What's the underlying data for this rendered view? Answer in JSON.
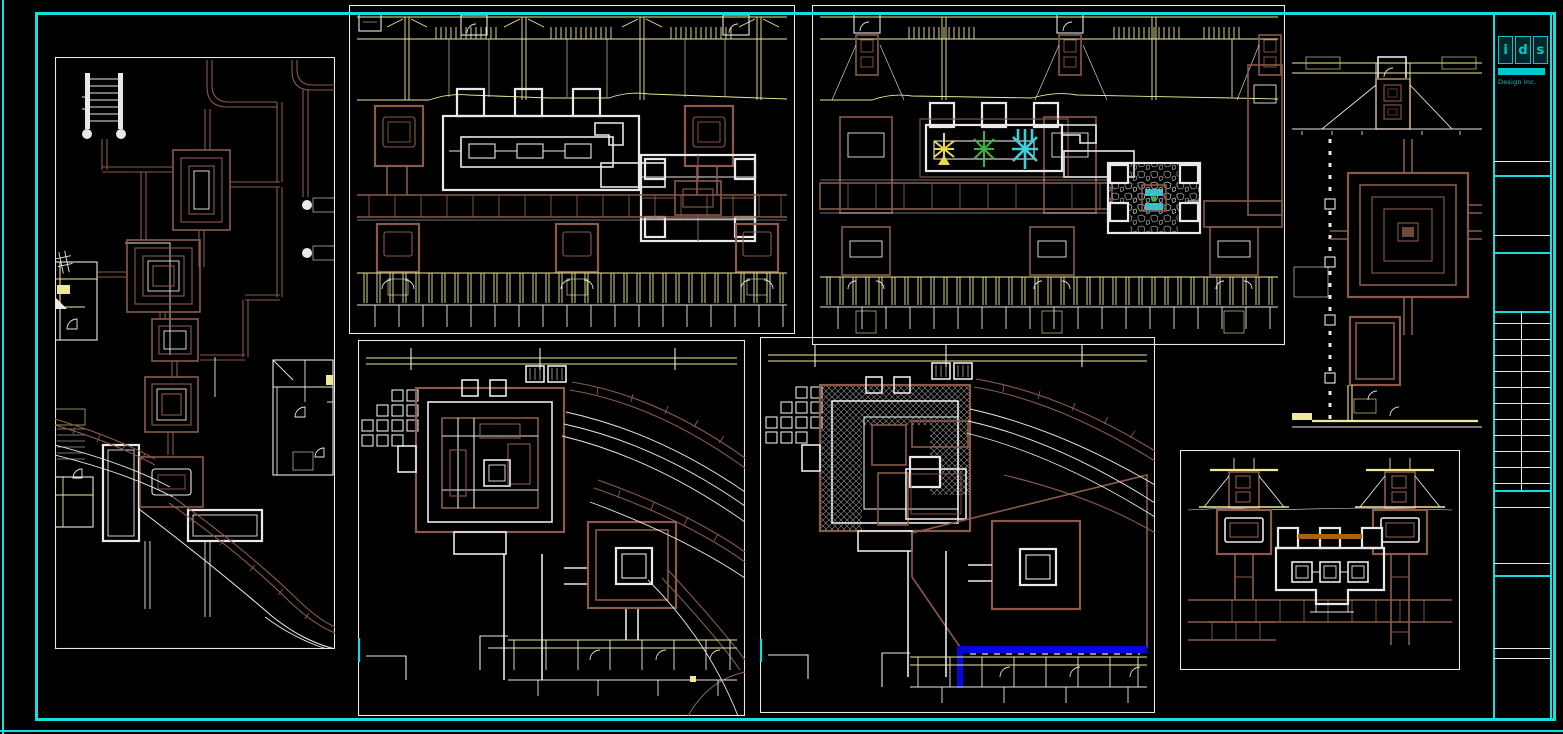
{
  "titleblock": {
    "letters": [
      "i",
      "d",
      "s"
    ],
    "subtitle": "Design Inc."
  },
  "colors": {
    "background": "#000000",
    "frame_cyan": "#17dede",
    "logo_cyan": "#00c8cc",
    "line_white": "#e9e9e9",
    "line_brown": "#8a5a4a",
    "line_yellow": "#efe99a",
    "hatch_gray": "#9a9a9a",
    "accent_blue": "#0505e0",
    "accent_orange": "#a86018",
    "plant_yellow": "#e8d84a",
    "plant_green": "#3bb53a",
    "plant_cyan": "#3ed0da"
  }
}
